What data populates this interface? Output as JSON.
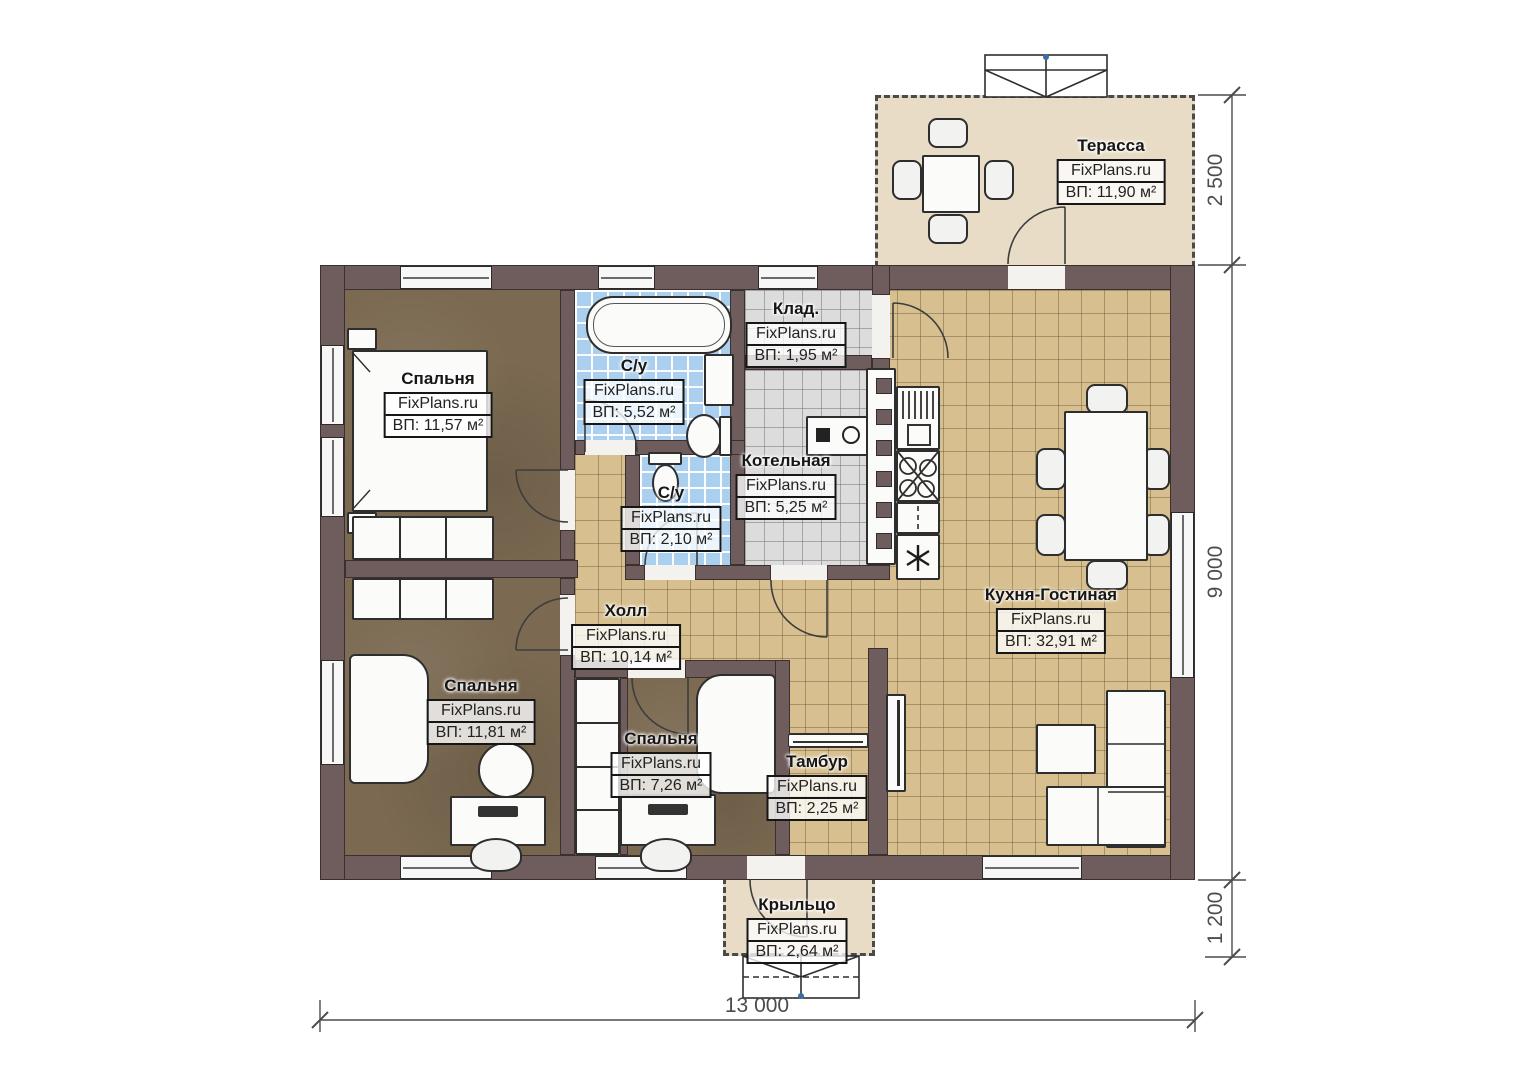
{
  "watermark": "FixPlans.ru",
  "rooms": {
    "terrace": {
      "name": "Терасса",
      "area": "ВП: 11,90 м²"
    },
    "bedroom_top": {
      "name": "Спальня",
      "area": "ВП: 11,57 м²"
    },
    "bathroom_main": {
      "name": "С/у",
      "area": "ВП: 5,52 м²"
    },
    "pantry": {
      "name": "Клад.",
      "area": "ВП: 1,95 м²"
    },
    "boiler": {
      "name": "Котельная",
      "area": "ВП: 5,25 м²"
    },
    "bathroom_small": {
      "name": "С/у",
      "area": "ВП: 2,10 м²"
    },
    "hall": {
      "name": "Холл",
      "area": "ВП: 10,14 м²"
    },
    "kitchen_living": {
      "name": "Кухня-Гостиная",
      "area": "ВП: 32,91 м²"
    },
    "bedroom_left": {
      "name": "Спальня",
      "area": "ВП: 11,81 м²"
    },
    "bedroom_bottom": {
      "name": "Спальня",
      "area": "ВП: 7,26 м²"
    },
    "vestibule": {
      "name": "Тамбур",
      "area": "ВП: 2,25 м²"
    },
    "porch": {
      "name": "Крыльцо",
      "area": "ВП: 2,64 м²"
    }
  },
  "dimensions": {
    "terrace_depth": "2 500",
    "house_height": "9 000",
    "porch_depth": "1 200",
    "house_width": "13 000"
  },
  "colors": {
    "wall": "#6f5c5c",
    "wood_floor": "#7b6951",
    "tile_tan": "#d7bf8f",
    "tile_blue": "#abd0ef",
    "tile_gray": "#dcdcdc",
    "outdoor": "#e8dcc6"
  }
}
